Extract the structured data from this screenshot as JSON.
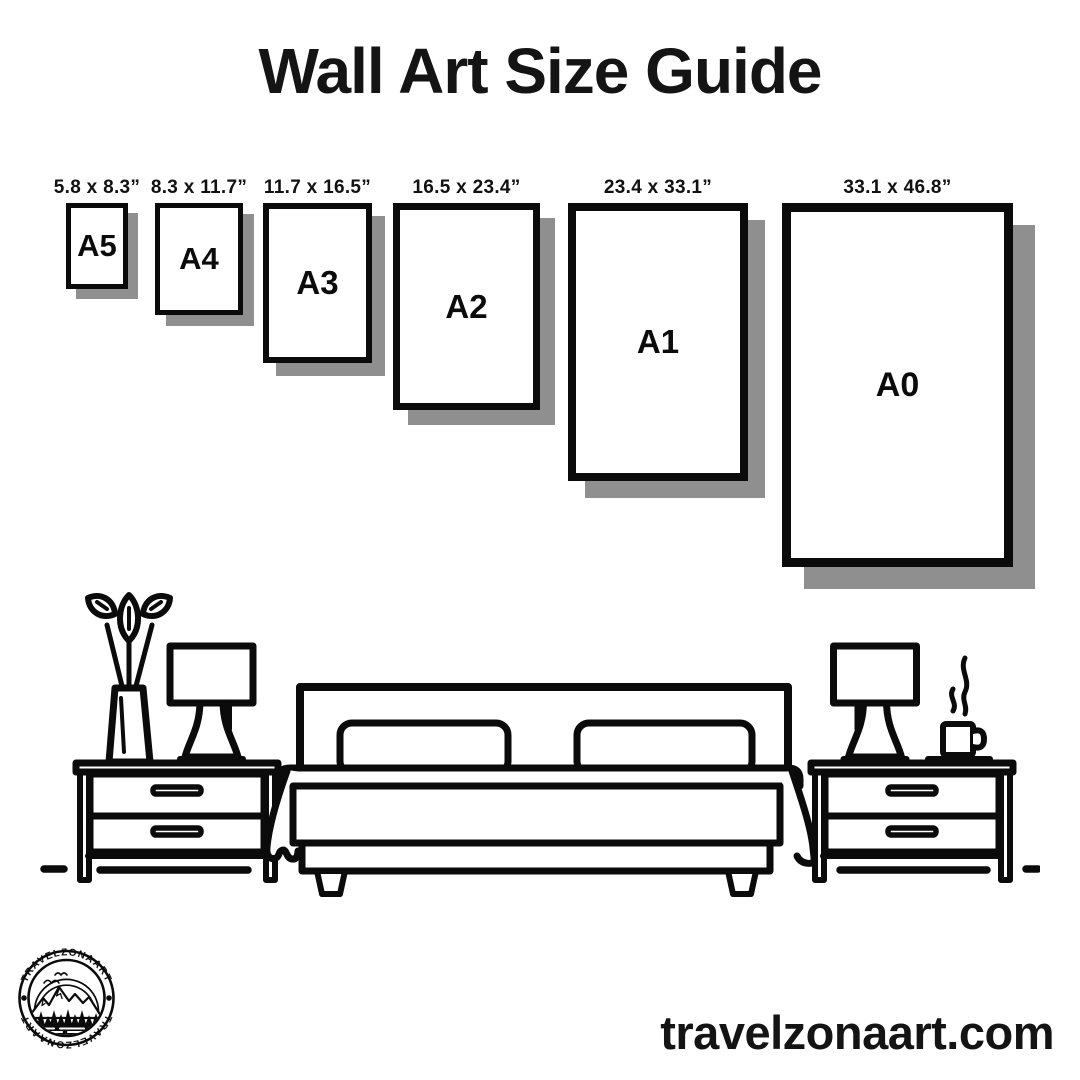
{
  "title": "Wall Art Size Guide",
  "frames": [
    {
      "name": "A5",
      "dims": "5.8 x 8.3”"
    },
    {
      "name": "A4",
      "dims": "8.3 x 11.7”"
    },
    {
      "name": "A3",
      "dims": "11.7 x 16.5”"
    },
    {
      "name": "A2",
      "dims": "16.5 x 23.4”"
    },
    {
      "name": "A1",
      "dims": "23.4 x 33.1”"
    },
    {
      "name": "A0",
      "dims": "33.1 x 46.8”"
    }
  ],
  "scene": {
    "items": [
      "plant-vase",
      "table-lamp",
      "nightstand",
      "double-bed",
      "table-lamp",
      "coffee-cup",
      "nightstand"
    ]
  },
  "logo": {
    "brand": "TRAVELZONAART"
  },
  "website": {
    "url": "travelzonaart.com"
  },
  "colors": {
    "ink": "#0b0b0b",
    "paper": "#ffffff",
    "shadow": "#8f8f8f"
  }
}
